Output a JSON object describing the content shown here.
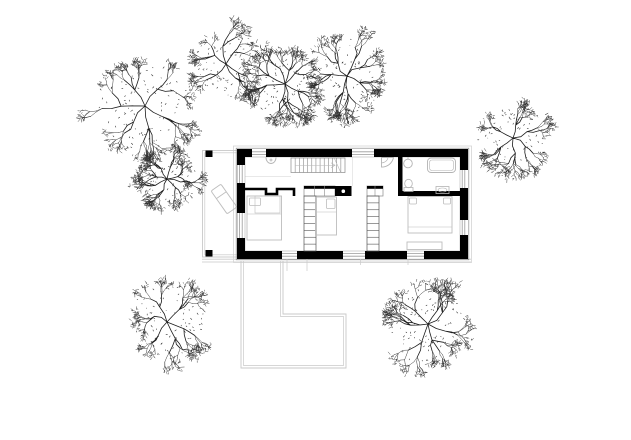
{
  "scene": {
    "type": "architectural-site-plan-drawing",
    "width": 631,
    "height": 440,
    "colors": {
      "background": "#ffffff",
      "wall_ink": "#000000",
      "wall_outline": "#8a8a8a",
      "inner_outline": "#b5b5b5",
      "glazing": "#9a9a9a",
      "site_line": "#c9c9c9",
      "eave_line": "#d4d4d4",
      "hairline": "#e0e0e0",
      "fixture": "#b3b3b3",
      "furniture": "#bdbdbd",
      "tree_main": "#1c1c1c",
      "tree_fine": "#2e2e2e"
    }
  },
  "site": {
    "ground_lines": [
      [
        202,
        259.2,
        471,
        259.2
      ],
      [
        202,
        262,
        471,
        262
      ]
    ],
    "eave_rect": [
      233.5,
      146,
      238,
      116.5
    ],
    "terrace": {
      "outer": [
        202.5,
        150.5,
        35,
        106.5
      ],
      "inner": [
        204.8,
        152.8,
        32.5,
        102
      ],
      "posts": [
        [
          205.5,
          150.5,
          7,
          6.5
        ],
        [
          205.5,
          250,
          7,
          6.5
        ]
      ],
      "lounge_chair": {
        "cx": 224,
        "cy": 199,
        "w": 12,
        "h": 28,
        "angle": -35
      }
    },
    "patio": {
      "outer": [
        [
          241,
          261
        ],
        [
          241,
          368
        ],
        [
          346,
          368
        ],
        [
          346,
          314
        ],
        [
          283,
          314
        ],
        [
          283,
          261
        ]
      ],
      "inner": [
        [
          243.5,
          261
        ],
        [
          243.5,
          365.5
        ],
        [
          343.5,
          365.5
        ],
        [
          343.5,
          316.5
        ],
        [
          280.5,
          316.5
        ],
        [
          280.5,
          261
        ]
      ]
    },
    "trees": [
      {
        "cx": 145,
        "cy": 106,
        "r": 46,
        "seed": 101
      },
      {
        "cx": 226,
        "cy": 64,
        "r": 36,
        "seed": 202
      },
      {
        "cx": 285,
        "cy": 84,
        "r": 35,
        "seed": 303
      },
      {
        "cx": 347,
        "cy": 76,
        "r": 36,
        "seed": 404
      },
      {
        "cx": 513,
        "cy": 138,
        "r": 34,
        "seed": 505
      },
      {
        "cx": 167,
        "cy": 179,
        "r": 28,
        "seed": 606
      },
      {
        "cx": 167,
        "cy": 322,
        "r": 36,
        "seed": 707
      },
      {
        "cx": 428,
        "cy": 324,
        "r": 38,
        "seed": 808
      }
    ]
  },
  "house": {
    "outer_outline": [
      236.2,
      148.2,
      232.6,
      111.6
    ],
    "inner_outline": [
      245,
      157,
      215,
      94
    ],
    "walls": [
      [
        237,
        149,
        15,
        8
      ],
      [
        237,
        149,
        8,
        16
      ],
      [
        266,
        149,
        86,
        8
      ],
      [
        374,
        149,
        94,
        8
      ],
      [
        460,
        149,
        8,
        21
      ],
      [
        460,
        188,
        8,
        32
      ],
      [
        460,
        235,
        8,
        24
      ],
      [
        237,
        183,
        8,
        30
      ],
      [
        237,
        238,
        8,
        21
      ],
      [
        237,
        251,
        45,
        8
      ],
      [
        297,
        251,
        46,
        8
      ],
      [
        365,
        251,
        42,
        8
      ],
      [
        424,
        251,
        44,
        8
      ],
      [
        398,
        157,
        4.5,
        39
      ],
      [
        402,
        191,
        58,
        5
      ]
    ],
    "window_lines": [
      [
        252,
        151.8,
        266,
        151.8
      ],
      [
        252,
        154.4,
        266,
        154.4
      ],
      [
        352,
        151.8,
        374,
        151.8
      ],
      [
        352,
        154.4,
        374,
        154.4
      ],
      [
        239.6,
        165,
        239.6,
        183
      ],
      [
        242.2,
        165,
        242.2,
        183
      ],
      [
        239.6,
        213,
        239.6,
        238
      ],
      [
        242.2,
        213,
        242.2,
        238
      ],
      [
        462.2,
        170,
        462.2,
        188
      ],
      [
        464.8,
        170,
        464.8,
        188
      ],
      [
        462.2,
        220,
        462.2,
        235
      ],
      [
        464.8,
        220,
        464.8,
        235
      ],
      [
        282,
        253.6,
        297,
        253.6
      ],
      [
        282,
        256.2,
        297,
        256.2
      ],
      [
        343,
        253.6,
        365,
        253.6
      ],
      [
        343,
        256.2,
        365,
        256.2
      ],
      [
        407,
        253.6,
        424,
        253.6
      ],
      [
        407,
        256.2,
        424,
        256.2
      ]
    ],
    "jamb_ticks": [
      [
        287,
        259,
        287,
        271
      ],
      [
        307,
        259,
        307,
        271
      ],
      [
        360.5,
        259,
        360.5,
        265
      ],
      [
        408,
        259,
        408,
        265
      ]
    ],
    "hairlines": [
      [
        352.5,
        157,
        352.5,
        186
      ],
      [
        245,
        176.5,
        291,
        176.5
      ]
    ],
    "closet_polyline": [
      [
        245,
        189
      ],
      [
        266,
        189
      ],
      [
        266,
        194
      ],
      [
        277,
        194
      ],
      [
        277,
        189
      ],
      [
        294,
        189
      ],
      [
        294,
        196
      ]
    ],
    "counters": [
      {
        "x": 304,
        "y": 186,
        "w": 31,
        "h": 10,
        "dividers": [
          314.3,
          324.7
        ]
      },
      {
        "x": 367,
        "y": 186,
        "w": 16,
        "h": 10,
        "dividers": [
          375
        ]
      }
    ],
    "stove": {
      "x": 335,
      "y": 186,
      "w": 16.5,
      "h": 10,
      "dot": [
        343.3,
        191.2
      ]
    },
    "stair": {
      "x": 291,
      "y": 158,
      "w": 54,
      "h": 14.5,
      "treads": 12
    },
    "ladders": [
      {
        "x": 304,
        "y": 196,
        "w": 12,
        "h": 55,
        "rungs": 7
      },
      {
        "x": 367,
        "y": 196,
        "w": 12,
        "h": 55,
        "rungs": 7
      }
    ],
    "fixtures": [
      {
        "type": "basin",
        "cx": 271,
        "cy": 157.5,
        "r": 5
      },
      {
        "type": "shower",
        "x": 381.5,
        "y": 157.5,
        "r": 12
      },
      {
        "type": "sink",
        "cx": 408,
        "cy": 163.5,
        "r": 4.3
      },
      {
        "type": "bathtub",
        "x": 427.5,
        "y": 158,
        "w": 28,
        "h": 14.5
      },
      {
        "type": "toilet",
        "cx": 408.5,
        "cy": 183.5
      },
      {
        "type": "vanity",
        "x": 436,
        "y": 186.5,
        "w": 13,
        "h": 7
      }
    ],
    "furniture": [
      {
        "type": "bed",
        "name": "bed-left",
        "x": 247,
        "y": 196,
        "w": 34.5,
        "h": 44,
        "pillows": [
          [
            249.5,
            198,
            11,
            7.5
          ]
        ],
        "inner": [
          255,
          196,
          25,
          17
        ],
        "fold_y": 214
      },
      {
        "type": "bed",
        "name": "bed-middle",
        "x": 315.5,
        "y": 197,
        "w": 21,
        "h": 38,
        "pillows": [
          [
            326.5,
            199,
            8.5,
            9.5
          ]
        ],
        "fold_y": 212
      },
      {
        "type": "bed",
        "name": "bed-right",
        "x": 408,
        "y": 196.5,
        "w": 44,
        "h": 36.5,
        "pillows": [
          [
            409.5,
            198,
            7,
            6
          ],
          [
            443.5,
            198,
            7,
            6
          ]
        ],
        "fold_y": 227
      },
      {
        "type": "rect",
        "name": "bench",
        "x": 407,
        "y": 242,
        "w": 35,
        "h": 7.5
      }
    ]
  }
}
